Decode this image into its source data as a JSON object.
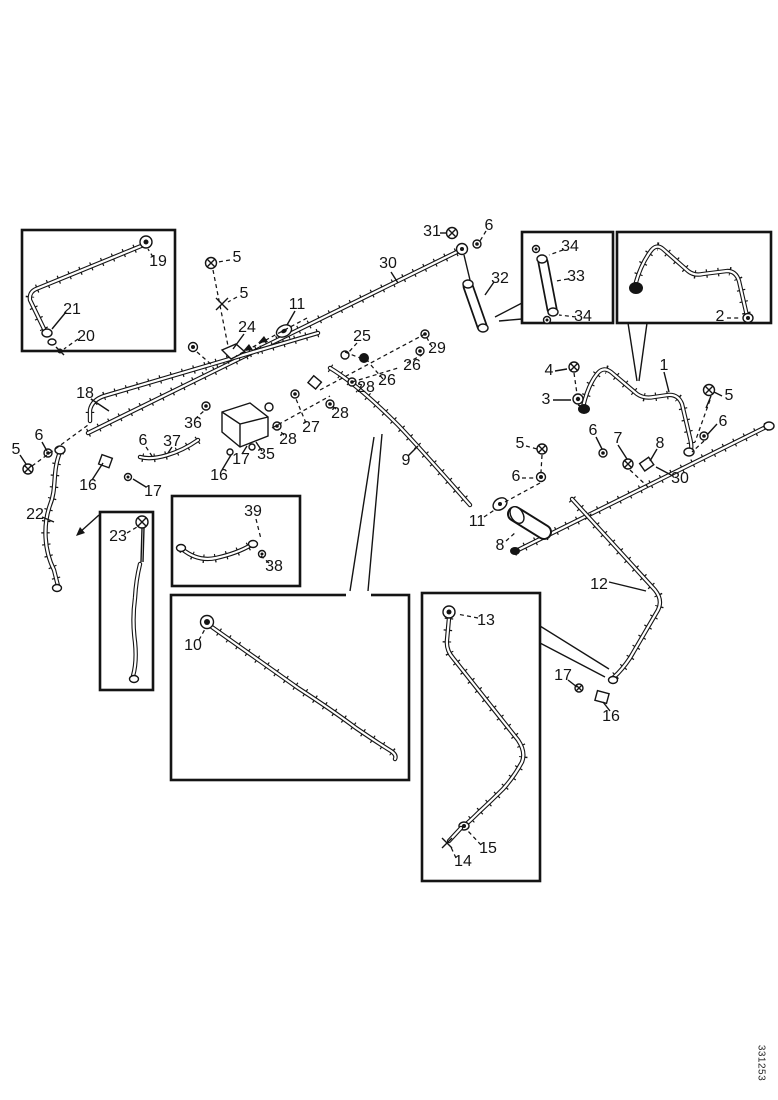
{
  "figure": {
    "kind": "exploded-parts-diagram",
    "description": "Black-and-white exploded parts line drawing of fuel/hydraulic tubing assemblies with numbered callouts and detail inset boxes",
    "background_color": "#ffffff",
    "ink_color": "#141414",
    "watermark": "331253",
    "callouts": [
      {
        "n": "19",
        "x": 158,
        "y": 262
      },
      {
        "n": "21",
        "x": 72,
        "y": 310
      },
      {
        "n": "20",
        "x": 86,
        "y": 337
      },
      {
        "n": "18",
        "x": 85,
        "y": 394
      },
      {
        "n": "6",
        "x": 39,
        "y": 436
      },
      {
        "n": "5",
        "x": 16,
        "y": 450
      },
      {
        "n": "16",
        "x": 88,
        "y": 486
      },
      {
        "n": "17",
        "x": 153,
        "y": 492
      },
      {
        "n": "22",
        "x": 35,
        "y": 515
      },
      {
        "n": "23",
        "x": 118,
        "y": 537
      },
      {
        "n": "5",
        "x": 237,
        "y": 258
      },
      {
        "n": "5",
        "x": 244,
        "y": 294
      },
      {
        "n": "24",
        "x": 247,
        "y": 328
      },
      {
        "n": "11",
        "x": 297,
        "y": 305
      },
      {
        "n": "30",
        "x": 388,
        "y": 264
      },
      {
        "n": "31",
        "x": 432,
        "y": 232
      },
      {
        "n": "6",
        "x": 489,
        "y": 226
      },
      {
        "n": "32",
        "x": 500,
        "y": 279
      },
      {
        "n": "25",
        "x": 362,
        "y": 337
      },
      {
        "n": "29",
        "x": 437,
        "y": 349
      },
      {
        "n": "26",
        "x": 412,
        "y": 366
      },
      {
        "n": "26",
        "x": 387,
        "y": 381
      },
      {
        "n": "28",
        "x": 366,
        "y": 388
      },
      {
        "n": "28",
        "x": 340,
        "y": 414
      },
      {
        "n": "27",
        "x": 311,
        "y": 428
      },
      {
        "n": "28",
        "x": 288,
        "y": 440
      },
      {
        "n": "36",
        "x": 193,
        "y": 424
      },
      {
        "n": "6",
        "x": 143,
        "y": 441
      },
      {
        "n": "37",
        "x": 172,
        "y": 442
      },
      {
        "n": "17",
        "x": 241,
        "y": 460
      },
      {
        "n": "35",
        "x": 266,
        "y": 455
      },
      {
        "n": "16",
        "x": 219,
        "y": 476
      },
      {
        "n": "39",
        "x": 253,
        "y": 512
      },
      {
        "n": "38",
        "x": 274,
        "y": 567
      },
      {
        "n": "10",
        "x": 193,
        "y": 646
      },
      {
        "n": "9",
        "x": 406,
        "y": 461
      },
      {
        "n": "11",
        "x": 477,
        "y": 522
      },
      {
        "n": "8",
        "x": 500,
        "y": 546
      },
      {
        "n": "6",
        "x": 516,
        "y": 477
      },
      {
        "n": "5",
        "x": 520,
        "y": 444
      },
      {
        "n": "4",
        "x": 549,
        "y": 371
      },
      {
        "n": "3",
        "x": 546,
        "y": 400
      },
      {
        "n": "1",
        "x": 664,
        "y": 366
      },
      {
        "n": "2",
        "x": 720,
        "y": 317
      },
      {
        "n": "34",
        "x": 570,
        "y": 247
      },
      {
        "n": "33",
        "x": 576,
        "y": 277
      },
      {
        "n": "34",
        "x": 583,
        "y": 317
      },
      {
        "n": "5",
        "x": 729,
        "y": 396
      },
      {
        "n": "6",
        "x": 723,
        "y": 422
      },
      {
        "n": "7",
        "x": 618,
        "y": 439
      },
      {
        "n": "8",
        "x": 660,
        "y": 444
      },
      {
        "n": "6",
        "x": 593,
        "y": 431
      },
      {
        "n": "30",
        "x": 680,
        "y": 479
      },
      {
        "n": "12",
        "x": 599,
        "y": 585
      },
      {
        "n": "13",
        "x": 486,
        "y": 621
      },
      {
        "n": "17",
        "x": 563,
        "y": 676
      },
      {
        "n": "16",
        "x": 611,
        "y": 717
      },
      {
        "n": "15",
        "x": 488,
        "y": 849
      },
      {
        "n": "14",
        "x": 463,
        "y": 862
      }
    ]
  }
}
